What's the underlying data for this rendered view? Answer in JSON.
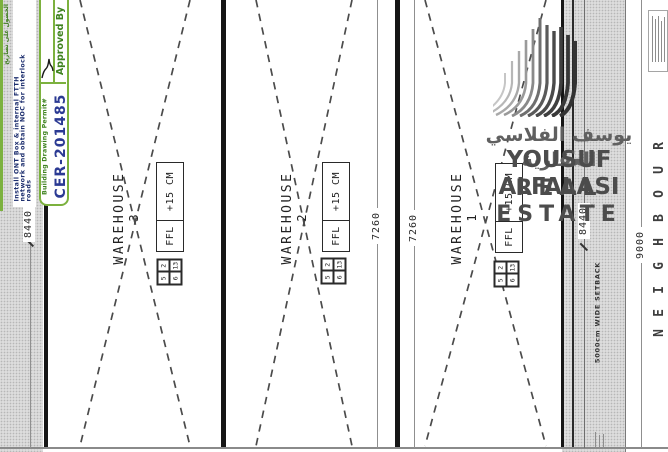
{
  "permit_panel": {
    "side_note_ar": "الحصول على تصاريح",
    "ftth_note_line1": "Install ONT Box & internal FTTH",
    "ftth_note_line2": "network and obtain NOC for interlock",
    "ftth_note_line3": "roads",
    "approved_by": "Approved By",
    "permit_label": "Building Drawing Permit#",
    "permit_number": "CER-201485",
    "accent_green": "#7cb13e",
    "permit_number_blue": "#2b3a93",
    "note_navy": "#1d2e6e"
  },
  "plan": {
    "warehouses": [
      {
        "label": "WAREHOUSE",
        "number": "3",
        "ffl_label": "FFL",
        "ffl_value": "+15 CM",
        "grid": [
          "5",
          "2",
          "6",
          "13"
        ]
      },
      {
        "label": "WAREHOUSE",
        "number": "2",
        "ffl_label": "FFL",
        "ffl_value": "+15 CM",
        "grid": [
          "5",
          "2",
          "6",
          "13"
        ]
      },
      {
        "label": "WAREHOUSE",
        "number": "1",
        "ffl_label": "FFL",
        "ffl_value": "+15 CM",
        "grid": [
          "5",
          "2",
          "6",
          "13"
        ]
      }
    ],
    "dimensions": [
      {
        "value": "8440"
      },
      {
        "value": "7260"
      },
      {
        "value": "7260"
      },
      {
        "value": "8440"
      },
      {
        "value": "9000"
      }
    ],
    "setback_label": "5000cm WIDE SETBACK",
    "neighbour_word": "NEIGHBOUR",
    "neighbour_letters": [
      "R",
      "U",
      "O",
      "B",
      "H",
      "G",
      "I",
      "E",
      "N"
    ],
    "line_color": "#151515",
    "brace_color": "#4b4b4b"
  },
  "watermark": {
    "name_ar": "يوسف الفلاسي العقارية",
    "name_en": "YOUSUF ALFALASI",
    "tagline_en": "REAL ESTATE",
    "text_color": "#4c4c4c"
  }
}
